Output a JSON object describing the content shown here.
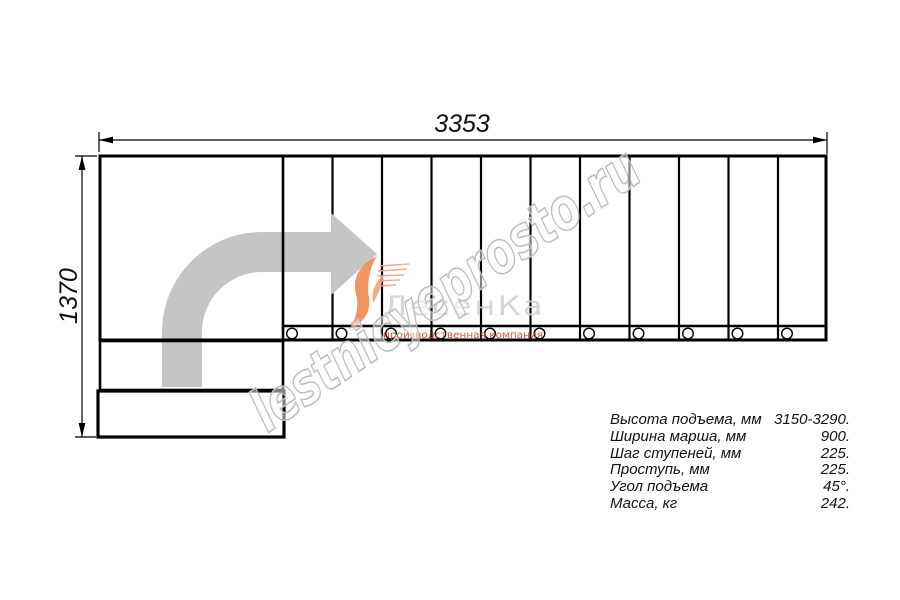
{
  "drawing": {
    "width_dimension": "3353",
    "height_dimension": "1370"
  },
  "specs": {
    "rows": [
      {
        "label": "Высота подъема, мм",
        "value": "3150-3290."
      },
      {
        "label": "Ширина марша, мм",
        "value": "900."
      },
      {
        "label": "Шаг ступеней, мм",
        "value": "225."
      },
      {
        "label": "Проступь, мм",
        "value": "225."
      },
      {
        "label": "Угол подъема",
        "value": "45°."
      },
      {
        "label": "Масса, кг",
        "value": "242."
      }
    ]
  },
  "watermark": {
    "site_text": "lestnicyeprosto.ru",
    "brand_name": "ЛесенКа",
    "brand_subtitle": "производственная компания"
  },
  "colors": {
    "line_black": "#000000",
    "arrow_gray": "#c5c5c5",
    "logo_orange": "#ef8a50",
    "logo_coral": "#f2a181",
    "brand_red": "#cc4433",
    "brand_gray": "#d2d2d2",
    "watermark_gray": "#bdbdbd"
  }
}
